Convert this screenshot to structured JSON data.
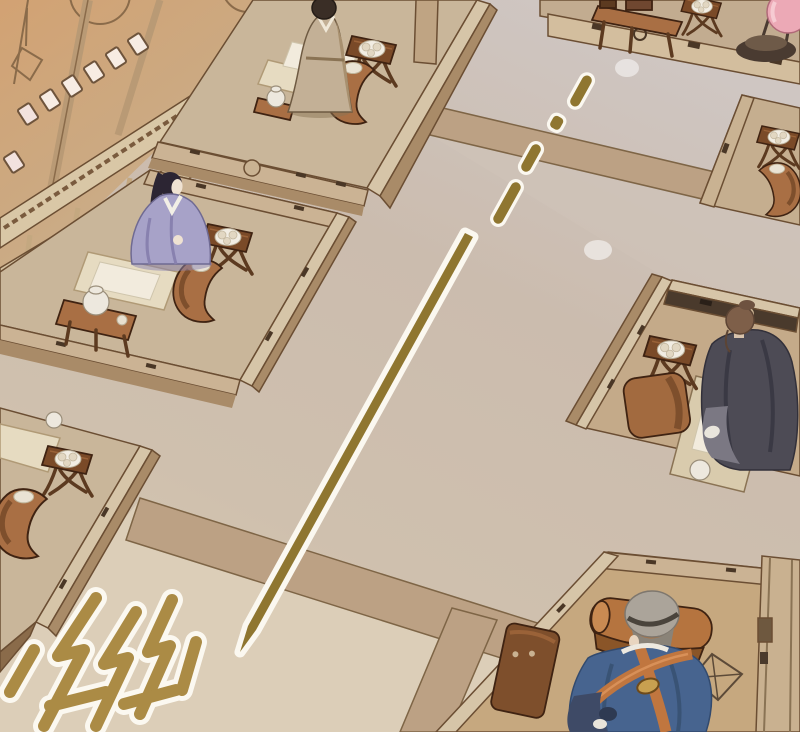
{
  "panel": {
    "type": "comic-panel",
    "width": 800,
    "height": 732,
    "description": "Overhead manhua scene of a traditional hall: rows of low platform desks with seated scholars, a gold staff flying diagonally across the floor leaving a dashed motion trail, and a stylized gold sound-effect glyph in the lower-left corner."
  },
  "palette": {
    "floor_top": "#CFC6C2",
    "floor_mid": "#CBBCAE",
    "floor_light": "#DCCFB8",
    "band_tan": "#BCA184",
    "band_outline": "#7E6546",
    "platform_top": "#C9B69A",
    "platform_top_warm": "#C4AA89",
    "platform_trim": "#CBB394",
    "platform_bevel": "#D6C5A8",
    "platform_side": "#A98B68",
    "outline_dark": "#6B4E33",
    "mat": "#E6DBC1",
    "paper": "#F2EBDD",
    "wood_dark": "#7A4A28",
    "wood_mid": "#A96F44",
    "wood_bench": "#B5743F",
    "plate": "#F2EDE3",
    "teapot": "#EDE8DE",
    "staff_gold": "#8F7630",
    "sfx_gold": "#AB8B45",
    "outline_white": "#FBF8F0",
    "wall_orange": "#D2A273",
    "wall_tan": "#C9B499",
    "wall_line": "#8A6B4A",
    "window_pane": "#F7ECE3",
    "rail_beige": "#D9C7A6",
    "carving": "#7A5B3E",
    "lantern_pink": "#ECA9B6",
    "lantern_stand": "#4A3B31",
    "robe_tan": "#C3B096",
    "robe_purple": "#A7A2C8",
    "robe_purple_shade": "#8881AF",
    "robe_dark": "#4D4B55",
    "robe_blue": "#47648F",
    "sash_orange": "#C0763F",
    "hair_black": "#2C2533",
    "hair_brown": "#7E5F49",
    "hair_gray": "#ABA49A",
    "skin": "#EFE2D2",
    "glow": "#FFFFFF"
  },
  "objects": {
    "staff": {
      "label": "flying gold staff",
      "trail_dashes": 4
    },
    "sfx": {
      "label": "impact sound-effect glyph"
    },
    "figures": [
      {
        "id": "attendant-top",
        "label": "standing attendant in tan robe"
      },
      {
        "id": "scholar-purple",
        "label": "seated scholar in lavender robe"
      },
      {
        "id": "scholar-dark",
        "label": "seated scholar in dark robe, back view"
      },
      {
        "id": "scholar-blue",
        "label": "seated scholar in blue robe with orange sash, back view"
      }
    ],
    "furniture": {
      "stool_tables_with_plates": 6,
      "curved_benches": 5,
      "tea_tables": 2,
      "writing_mats": 5,
      "lantern": 1
    }
  }
}
